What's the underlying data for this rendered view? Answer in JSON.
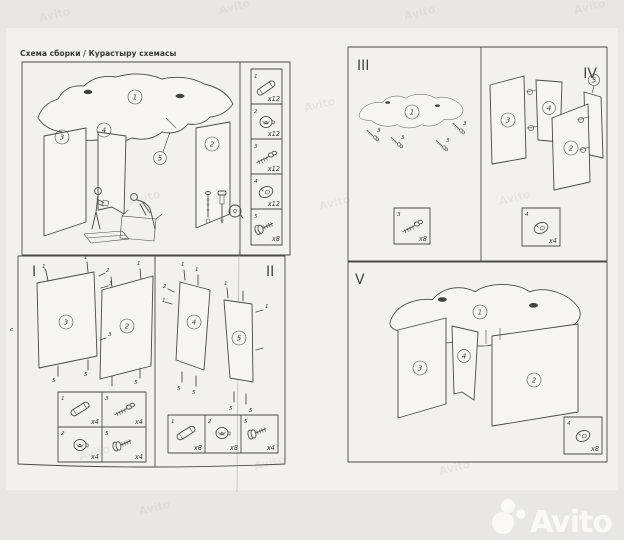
{
  "page": {
    "title": "Схема сборки / Курастыру схемасы",
    "watermark_tile": "Avito",
    "watermark_logo": "Avito",
    "side_mark": "c"
  },
  "main_view": {
    "part_labels": {
      "top": "1",
      "right_panel": "2",
      "left_panel": "3",
      "center_panel": "4",
      "brace": "5"
    }
  },
  "hardware_list": {
    "items": [
      {
        "num": "1",
        "icon": "dowel-icon",
        "qty": "x12"
      },
      {
        "num": "2",
        "icon": "cam-lock-icon",
        "qty": "x12"
      },
      {
        "num": "3",
        "icon": "minifix-bolt-icon",
        "qty": "x12"
      },
      {
        "num": "4",
        "icon": "cam-disc-icon",
        "qty": "x12"
      },
      {
        "num": "5",
        "icon": "screw-icon",
        "qty": "x8"
      }
    ]
  },
  "steps": {
    "s1": {
      "label": "I",
      "panel_a": "3",
      "panel_b": "2",
      "markers": [
        "1",
        "2",
        "3",
        "1",
        "1",
        "3",
        "5",
        "5",
        "5"
      ],
      "parts": [
        {
          "num": "1",
          "icon": "dowel-icon",
          "qty": "x4"
        },
        {
          "num": "3",
          "icon": "minifix-bolt-icon",
          "qty": "x4"
        },
        {
          "num": "2",
          "icon": "cam-lock-icon",
          "qty": "x4"
        },
        {
          "num": "5",
          "icon": "screw-icon",
          "qty": "x4"
        }
      ]
    },
    "s2": {
      "label": "II",
      "panel_a": "4",
      "panel_b": "5",
      "markers": [
        "1",
        "1",
        "2",
        "1",
        "5",
        "5",
        "1",
        "1",
        "5",
        "5"
      ],
      "parts": [
        {
          "num": "1",
          "icon": "dowel-icon",
          "qty": "x8"
        },
        {
          "num": "2",
          "icon": "cam-lock-icon",
          "qty": "x8"
        },
        {
          "num": "5",
          "icon": "screw-icon",
          "qty": "x4"
        }
      ]
    },
    "s3": {
      "label": "III",
      "panel": "1",
      "markers": [
        "3",
        "3",
        "3",
        "3"
      ],
      "parts": [
        {
          "num": "3",
          "icon": "minifix-bolt-icon",
          "qty": "x8"
        }
      ]
    },
    "s4": {
      "label": "IV",
      "callout": "5",
      "panels": {
        "left": "3",
        "center": "4",
        "right": "2",
        "strip": "5"
      },
      "parts": [
        {
          "num": "4",
          "icon": "cam-disc-icon",
          "qty": "x4"
        }
      ]
    },
    "s5": {
      "label": "V",
      "panels": {
        "top": "1",
        "left": "3",
        "center": "4",
        "right": "2"
      },
      "parts": [
        {
          "num": "4",
          "icon": "cam-disc-icon",
          "qty": "x8"
        }
      ]
    }
  }
}
